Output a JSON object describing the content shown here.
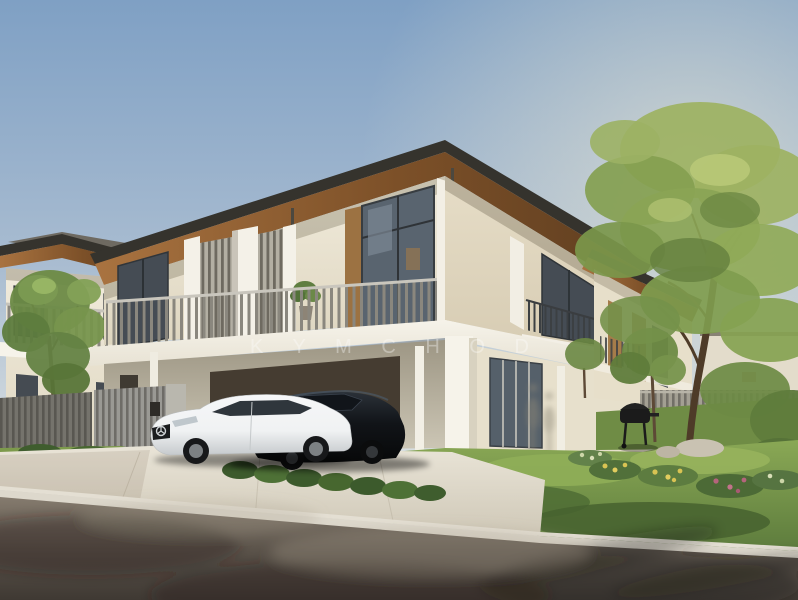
{
  "image": {
    "type": "architectural-rendering",
    "description": "Exterior rendering of modern two-storey terrace homes: cream walls, timber-soffit flat roofs, grey vertical-slat balcony railings, a white coupe and a black sedan parked in the driveway, landscaped garden with flower bushes, rocks and a BBQ grill, large leafy tree on the right, clear blue sky.",
    "watermark": {
      "text": "K Y M  C H O D"
    }
  },
  "palette": {
    "sky_top": "#7fa0c4",
    "sky_mid": "#aabdd1",
    "sky_horizon": "#dfe3e3",
    "roof_dark": "#35332d",
    "wood_light": "#a97340",
    "wood_dark": "#5f3e20",
    "wall_light": "#f1ebdc",
    "wall_right": "#e6ddc7",
    "slab_white": "#f6f3ea",
    "rail_gray": "#8a877e",
    "glass_dark": "#454c54",
    "glass_mid": "#59646f",
    "wood_accent": "#a57c4a",
    "lawn_light": "#8aa855",
    "lawn_dark": "#5b7a3c",
    "leaf_light": "#9db262",
    "leaf_dark": "#6d8a44",
    "trunk": "#4e3b28",
    "road_light": "#857b6e",
    "road_dark": "#3f3933",
    "curb_light": "#ddd8cc",
    "drive_light": "#e9e4d7",
    "car_white": "#f0f2f3",
    "car_black": "#111418",
    "gate_gray": "#9a9994",
    "fence_gray": "#75736c"
  }
}
